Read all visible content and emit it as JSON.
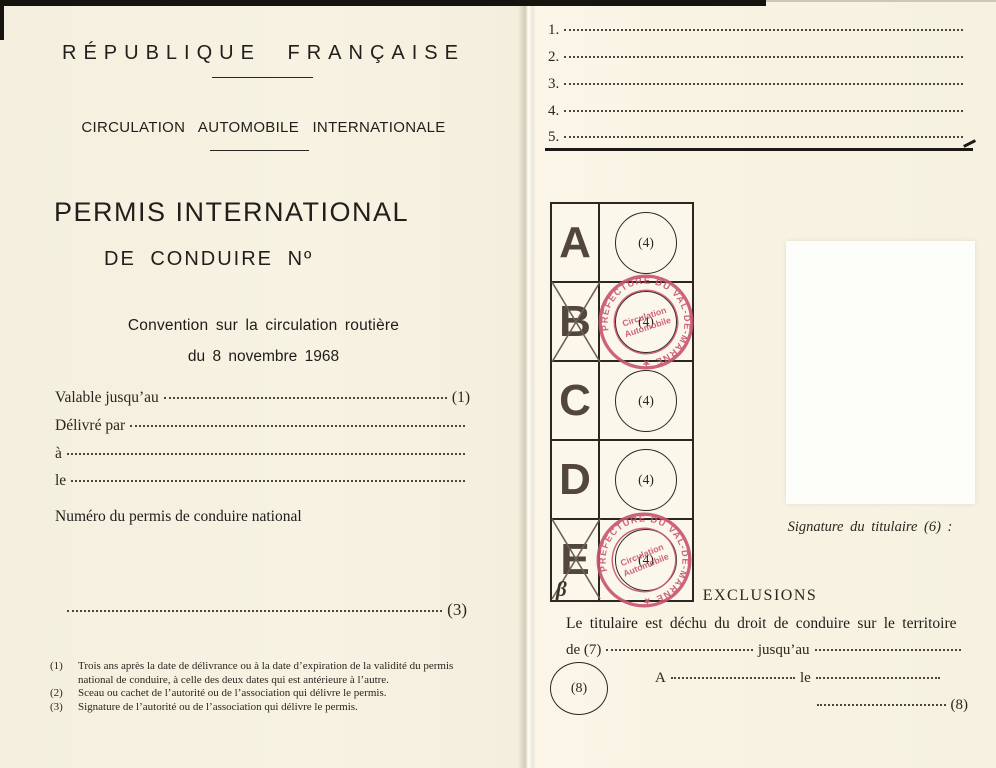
{
  "left_page": {
    "title": "RÉPUBLIQUE FRANÇAISE",
    "subtitle": "CIRCULATION AUTOMOBILE INTERNATIONALE",
    "permit_title": "PERMIS INTERNATIONAL",
    "permit_number_title": "DE CONDUIRE Nº",
    "convention_line1": "Convention sur la circulation routière",
    "convention_line2": "du 8 novembre 1968",
    "fields": [
      {
        "label": "Valable jusqu’au",
        "suffix": "(1)"
      },
      {
        "label": "Délivré par",
        "suffix": ""
      },
      {
        "label": "à",
        "suffix": ""
      },
      {
        "label": "le",
        "suffix": ""
      }
    ],
    "national_permit_label": "Numéro du permis de conduire national",
    "signature_line_suffix": "(3)",
    "footnotes": [
      {
        "num": "(1)",
        "text": "Trois ans après la date de délivrance ou à la date d’expiration de la validité du permis national de conduire, à celle des deux dates qui est antérieure à l’autre."
      },
      {
        "num": "(2)",
        "text": "Sceau ou cachet de l’autorité ou de l’association qui délivre le permis."
      },
      {
        "num": "(3)",
        "text": "Signature de l’autorité ou de l’association qui délivre le permis."
      }
    ]
  },
  "right_page": {
    "list_items": [
      {
        "num": "1."
      },
      {
        "num": "2."
      },
      {
        "num": "3."
      },
      {
        "num": "4."
      },
      {
        "num": "5."
      }
    ],
    "categories": [
      {
        "letter": "A",
        "circle_label": "(4)",
        "crossed": false,
        "stamped": false
      },
      {
        "letter": "B",
        "circle_label": "(4)",
        "crossed": true,
        "stamped": true
      },
      {
        "letter": "C",
        "circle_label": "(4)",
        "crossed": false,
        "stamped": false
      },
      {
        "letter": "D",
        "circle_label": "(4)",
        "crossed": false,
        "stamped": false
      },
      {
        "letter": "E",
        "circle_label": "(4)",
        "crossed": true,
        "stamped": true,
        "handwritten": "β"
      }
    ],
    "stamp": {
      "ring_text": "PRÉFECTURE DU VAL-DE-MARNE ★",
      "center_line1": "Circulation",
      "center_line2": "Automobile",
      "color": "#c9536f"
    },
    "signature_label": "Signature du titulaire (6) :",
    "exclusions": {
      "heading": "EXCLUSIONS",
      "body": "Le titulaire est déchu du droit de conduire sur le territoire",
      "de_label": "de (7)",
      "jusquau_label": "jusqu’au",
      "a_label": "A",
      "le_label": "le",
      "line_suffix": "(8)",
      "circle_label": "(8)"
    }
  },
  "colors": {
    "paper": "#f6f1e1",
    "ink": "#211e1b",
    "stamp_pink": "#c9536f",
    "table_border": "#2b2824"
  }
}
